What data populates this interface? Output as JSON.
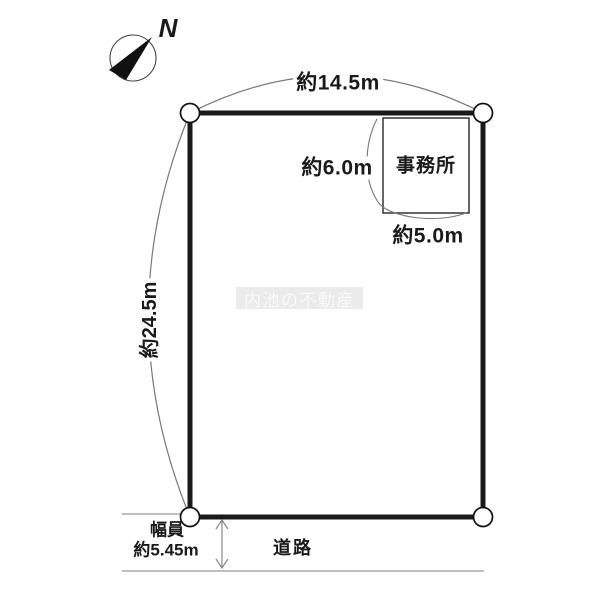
{
  "diagram": {
    "compass": {
      "north_label": "N"
    },
    "plot": {
      "width_label": "約14.5m",
      "depth_label": "約24.5m",
      "office": {
        "name": "事務所",
        "depth_label": "約6.0m",
        "width_label": "約5.0m"
      }
    },
    "road": {
      "name_label": "道路",
      "width_caption": "幅員",
      "width_value": "約5.45m"
    },
    "watermark": "内池の不動産"
  },
  "colors": {
    "outline_black": "#1a1a1a",
    "thin_line_gray": "#888888",
    "watermark_background": "#ebebeb",
    "watermark_text": "#fafafa"
  }
}
